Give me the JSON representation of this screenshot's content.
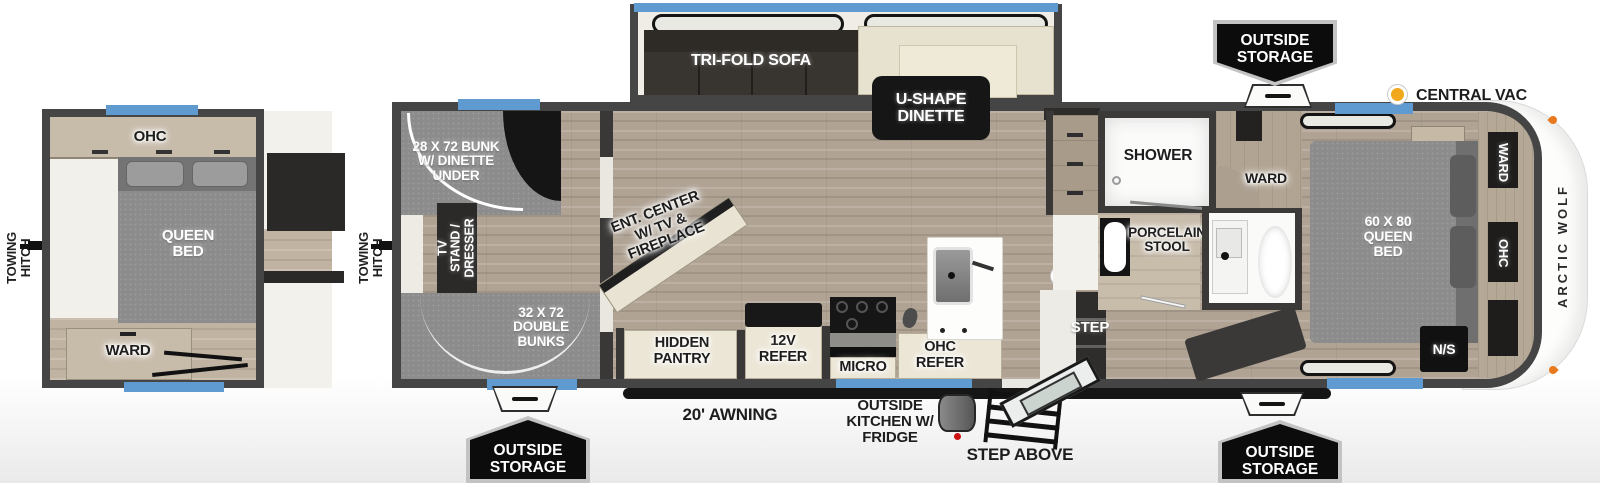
{
  "inset": {
    "towing_hitch": "TOWING HITCH",
    "ohc": "OHC",
    "queen_bed": "QUEEN BED",
    "ward": "WARD"
  },
  "main": {
    "towing_hitch": "TOWING HITCH",
    "bunk_dinette": "28 X 72 BUNK W/ DINETTE UNDER",
    "tv_stand": "TV STAND / DRESSER",
    "double_bunks": "32 X 72 DOUBLE BUNKS",
    "sofa": "TRI-FOLD SOFA",
    "dinette": "U-SHAPE DINETTE",
    "ent_center": "ENT. CENTER W/ TV & FIREPLACE",
    "hidden_pantry": "HIDDEN PANTRY",
    "refer_12v": "12V REFER",
    "micro": "MICRO",
    "ohc_refer": "OHC REFER",
    "shower": "SHOWER",
    "stool": "PORCELAIN STOOL",
    "ward_mid": "WARD",
    "step": "STEP",
    "queen_bed": "60 X 80 QUEEN BED",
    "ward_front": "WARD",
    "ohc_front": "OHC",
    "nightstand": "N/S",
    "brand": "ARCTIC WOLF"
  },
  "legend": {
    "central_vac": "CENTRAL VAC"
  },
  "exterior": {
    "awning": "20' AWNING",
    "outside_kitchen": "OUTSIDE KITCHEN W/ FRIDGE",
    "step_above": "STEP ABOVE",
    "storage_top": "OUTSIDE STORAGE",
    "storage_bottom_left": "OUTSIDE STORAGE",
    "storage_bottom_right": "OUTSIDE STORAGE"
  },
  "colors": {
    "window_blue": "#5f9bd0",
    "central_vac_yellow": "#f2a81d",
    "clearance_orange": "#e8791e"
  }
}
